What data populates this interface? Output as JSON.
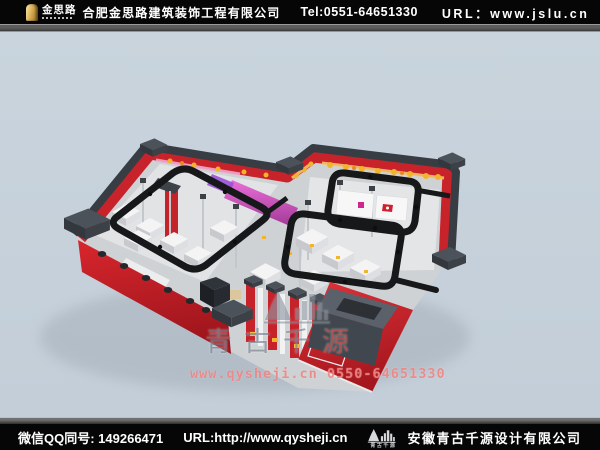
{
  "header": {
    "logo": {
      "brand": "金思路"
    },
    "company": "合肥金思路建筑装饰工程有限公司",
    "tel": "Tel:0551-64651330",
    "url_label": "URL：",
    "url_value": "www.jslu.cn"
  },
  "footer": {
    "qq": "微信QQ同号: 149266471",
    "url": "URL:http://www.qysheji.cn",
    "logo_caption": "青古千源",
    "company": "安徽青古千源设计有限公司"
  },
  "watermark": {
    "brand_main": "青古千",
    "brand_accent": "源",
    "contact": "www.qysheji.cn  0550-64651330"
  },
  "scene": {
    "type": "isometric-3d-interior-render",
    "subject": "retail store interior cutaway with red walls and black ceiling light tracks",
    "colors": {
      "background": "#c6d1da",
      "wall_red": "#cc2128",
      "frame_dark": "#3a3e45",
      "track_black": "#17181a",
      "floor": "#d8dadc",
      "accent_yellow": "#f2b42c",
      "accent_pink": "#d45cc3"
    }
  }
}
